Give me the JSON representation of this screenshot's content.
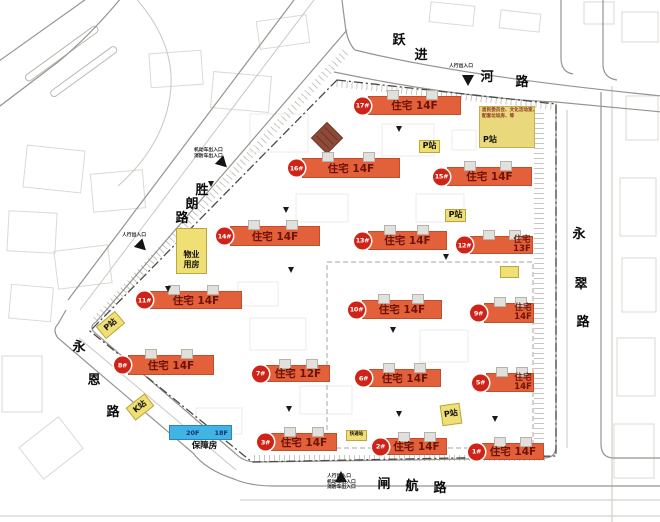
{
  "roads": [
    {
      "name": "跃进河路",
      "chars": [
        {
          "c": "跃",
          "x": 391,
          "y": 33
        },
        {
          "c": "进",
          "x": 413,
          "y": 48
        },
        {
          "c": "河",
          "x": 479,
          "y": 70
        },
        {
          "c": "路",
          "x": 514,
          "y": 75
        }
      ]
    },
    {
      "name": "胜朗路",
      "chars": [
        {
          "c": "胜",
          "x": 194,
          "y": 183
        },
        {
          "c": "朗",
          "x": 184,
          "y": 197
        },
        {
          "c": "路",
          "x": 174,
          "y": 211
        }
      ]
    },
    {
      "name": "永翠路",
      "chars": [
        {
          "c": "永",
          "x": 571,
          "y": 227
        },
        {
          "c": "翠",
          "x": 573,
          "y": 277
        },
        {
          "c": "路",
          "x": 575,
          "y": 315
        }
      ]
    },
    {
      "name": "永恩路",
      "chars": [
        {
          "c": "永",
          "x": 71,
          "y": 340
        },
        {
          "c": "恩",
          "x": 86,
          "y": 373
        },
        {
          "c": "路",
          "x": 105,
          "y": 405
        }
      ]
    },
    {
      "name": "闸航路",
      "chars": [
        {
          "c": "闸",
          "x": 376,
          "y": 477
        },
        {
          "c": "航",
          "x": 404,
          "y": 479
        },
        {
          "c": "路",
          "x": 432,
          "y": 481
        }
      ]
    }
  ],
  "buildings": [
    {
      "badge": "17#",
      "label": "住宅 14F",
      "stacked": false,
      "x": 368,
      "y": 96,
      "w": 93,
      "h": 19
    },
    {
      "badge": "16#",
      "label": "住宅 14F",
      "stacked": false,
      "x": 302,
      "y": 158,
      "w": 98,
      "h": 20
    },
    {
      "badge": "15#",
      "label": "住宅 14F",
      "stacked": false,
      "x": 447,
      "y": 167,
      "w": 85,
      "h": 19
    },
    {
      "badge": "14#",
      "label": "住宅 14F",
      "stacked": false,
      "x": 230,
      "y": 226,
      "w": 90,
      "h": 20
    },
    {
      "badge": "13#",
      "label": "住宅 14F",
      "stacked": false,
      "x": 368,
      "y": 231,
      "w": 79,
      "h": 19
    },
    {
      "badge": "12#",
      "label": "住宅",
      "floor": "13F",
      "stacked": true,
      "x": 470,
      "y": 236,
      "w": 63,
      "h": 18
    },
    {
      "badge": "11#",
      "label": "住宅 14F",
      "stacked": false,
      "x": 150,
      "y": 291,
      "w": 92,
      "h": 18
    },
    {
      "badge": "10#",
      "label": "住宅 14F",
      "stacked": false,
      "x": 362,
      "y": 300,
      "w": 80,
      "h": 19
    },
    {
      "badge": "9#",
      "label": "住宅",
      "floor": "14F",
      "stacked": true,
      "x": 484,
      "y": 303,
      "w": 50,
      "h": 20
    },
    {
      "badge": "8#",
      "label": "住宅 14F",
      "stacked": false,
      "x": 128,
      "y": 355,
      "w": 86,
      "h": 20
    },
    {
      "badge": "7#",
      "label": "住宅 12F",
      "stacked": false,
      "x": 266,
      "y": 365,
      "w": 64,
      "h": 17
    },
    {
      "badge": "6#",
      "label": "住宅 14F",
      "stacked": false,
      "x": 369,
      "y": 369,
      "w": 72,
      "h": 18
    },
    {
      "badge": "5#",
      "label": "住宅",
      "floor": "14F",
      "stacked": true,
      "x": 486,
      "y": 373,
      "w": 48,
      "h": 19
    },
    {
      "badge": "3#",
      "label": "住宅 14F",
      "stacked": false,
      "x": 271,
      "y": 433,
      "w": 66,
      "h": 18
    },
    {
      "badge": "2#",
      "label": "住宅 14F",
      "stacked": false,
      "x": 386,
      "y": 438,
      "w": 61,
      "h": 17
    },
    {
      "badge": "1#",
      "label": "住宅 14F",
      "stacked": false,
      "x": 482,
      "y": 443,
      "w": 62,
      "h": 17
    }
  ],
  "affordable": {
    "x": 169,
    "y": 425,
    "w": 63,
    "segments": [
      "20F",
      "18F"
    ],
    "caption": "保障房"
  },
  "facilities": [
    {
      "lines": [
        "P站"
      ],
      "x": 419,
      "y": 140,
      "w": 21,
      "h": 13,
      "rot": 0,
      "fs": 8,
      "bottom": false
    },
    {
      "lines": [
        "P站"
      ],
      "x": 445,
      "y": 209,
      "w": 21,
      "h": 13,
      "rot": 0,
      "fs": 8,
      "bottom": false
    },
    {
      "lines": [
        "P站"
      ],
      "x": 98,
      "y": 317,
      "w": 25,
      "h": 16,
      "rot": -40,
      "fs": 8,
      "bottom": false
    },
    {
      "lines": [
        "P站"
      ],
      "x": 441,
      "y": 404,
      "w": 20,
      "h": 21,
      "rot": -8,
      "fs": 8,
      "bottom": false
    },
    {
      "lines": [
        "K站"
      ],
      "x": 128,
      "y": 399,
      "w": 24,
      "h": 16,
      "rot": -38,
      "fs": 8,
      "bottom": false
    },
    {
      "lines": [
        "物业",
        "用房"
      ],
      "x": 176,
      "y": 228,
      "w": 31,
      "h": 46,
      "rot": 0,
      "fs": 8,
      "bottom": true
    },
    {
      "lines": [
        "快递站"
      ],
      "x": 346,
      "y": 430,
      "w": 21,
      "h": 11,
      "rot": 0,
      "fs": 4.5,
      "bottom": false
    },
    {
      "lines": [],
      "x": 500,
      "y": 266,
      "w": 19,
      "h": 12,
      "rot": 0,
      "fs": 4.5,
      "bottom": false
    }
  ],
  "annotation": {
    "x": 479,
    "y": 106,
    "w": 56,
    "h": 42,
    "lines": [
      "居民委员会、文化活动室、",
      "配套垃圾房、等"
    ],
    "label": "P站"
  },
  "entrances": [
    {
      "lines": [
        "人行出入口"
      ],
      "tx": 449,
      "ty": 64,
      "trix": 462,
      "triy": 75,
      "dir": "down"
    },
    {
      "lines": [
        "机动车出入口",
        "消防车出入口"
      ],
      "tx": 194,
      "ty": 148,
      "trix": 217,
      "triy": 158,
      "dir": "se"
    },
    {
      "lines": [
        "人行出入口"
      ],
      "tx": 122,
      "ty": 233,
      "trix": 136,
      "triy": 241,
      "dir": "se"
    },
    {
      "lines": [
        "人行出入口",
        "机动车出入口",
        "消防车出入口"
      ],
      "tx": 327,
      "ty": 474,
      "trix": 335,
      "triy": 471,
      "dir": "up"
    }
  ],
  "markers": [
    [
      396,
      126
    ],
    [
      283,
      207
    ],
    [
      288,
      267
    ],
    [
      165,
      286
    ],
    [
      390,
      327
    ],
    [
      286,
      406
    ],
    [
      396,
      411
    ],
    [
      492,
      416
    ],
    [
      443,
      254
    ],
    [
      208,
      181
    ]
  ],
  "colors": {
    "building": "#e2603a",
    "badge": "#d02317",
    "label_text": "#6e1205",
    "facility": "#f0df74",
    "affordable": "#41b4e6",
    "annotation_box": "#e9d97c",
    "boundary": "#4a4a48"
  }
}
